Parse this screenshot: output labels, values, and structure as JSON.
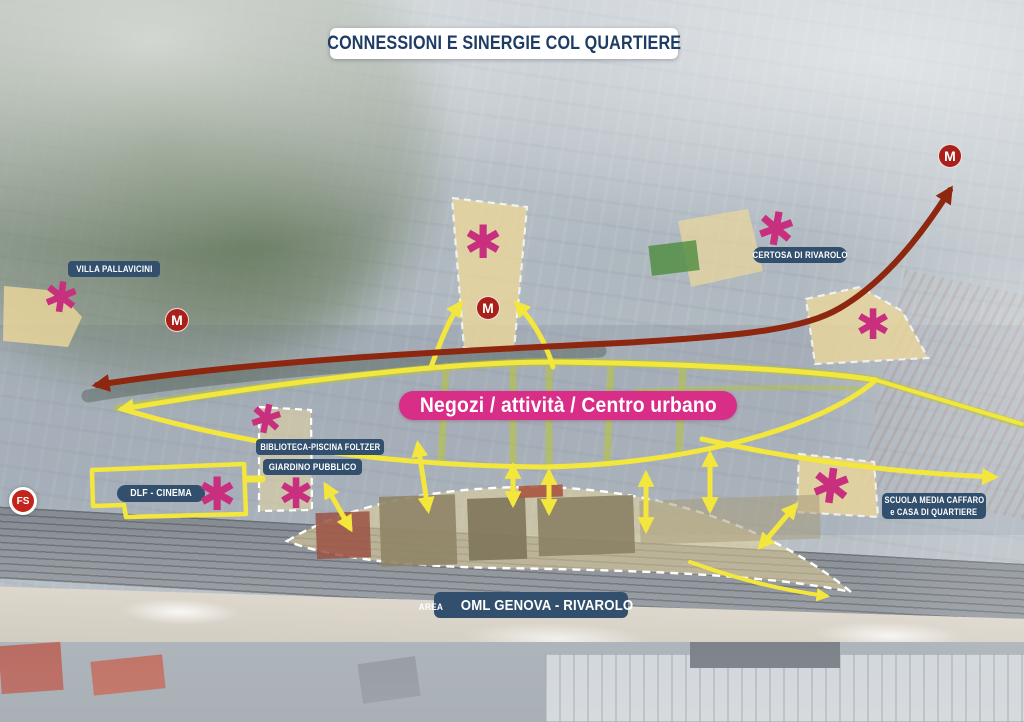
{
  "title": "CONNESSIONI E SINERGIE COL QUARTIERE",
  "labels": {
    "villa_pallavicini": "VILLA PALLAVICINI",
    "certosa_di_rivarolo": "CERTOSA DI RIVAROLO",
    "biblioteca_piscina": "BIBLIOTECA-PISCINA FOLTZER",
    "giardino_pubblico": "GIARDINO PUBBLICO",
    "dlf_cinema": "DLF - CINEMA",
    "scuola_line1": "SCUOLA MEDIA CAFFARO",
    "scuola_line2": "e CASA DI QUARTIERE",
    "area_oml_prefix": "AREA",
    "area_oml_name": "OML GENOVA - RIVAROLO",
    "negozi_banner": "Negozi / attività / Centro urbano"
  },
  "markers": {
    "metro_label": "M",
    "fs_label": "FS",
    "poi_glyph": "✱"
  },
  "colors": {
    "navy_banner": "#32506e",
    "pink_banner": "#d92e87",
    "poi_pink": "#c8307f",
    "metro_red": "#a91f1a",
    "fs_red": "#c3241c",
    "yellow_connections": "#f3e63d",
    "olive_streets": "#b9c636",
    "red_metro_axis": "#8e2710",
    "area_highlight": "#ecd79b"
  }
}
